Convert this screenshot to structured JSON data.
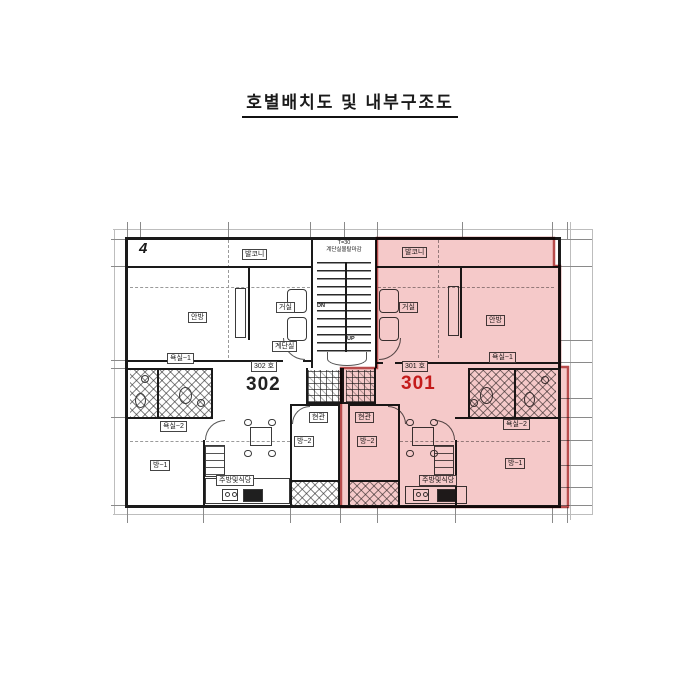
{
  "title": "호별배치도 및 내부구조도",
  "corner_mark": "4",
  "stairwell": {
    "note_top": "T=30",
    "note_bottom": "계단실몰탈마감",
    "label": "계단실",
    "down": "DN",
    "up": "UP"
  },
  "colors": {
    "highlight_fill": "#f5c6c6",
    "highlight_border": "#b84c4c",
    "unit_301_number_color": "#cc2222",
    "unit_302_number_color": "#222222",
    "wall_color": "#1a1a1a"
  },
  "unit_302": {
    "number": "302",
    "designation": "302 호",
    "balcony": "발코니",
    "master_bedroom": "안방",
    "living_room": "거실",
    "entrance": "현관",
    "bedroom1": "방~1",
    "bedroom2": "방~2",
    "bathroom1": "욕실~1",
    "bathroom2": "욕실~2",
    "kitchen_dining": "주방및식당"
  },
  "unit_301": {
    "number": "301",
    "designation": "301 호",
    "balcony": "발코니",
    "master_bedroom": "안방",
    "living_room": "거실",
    "entrance": "현관",
    "bedroom1": "방~1",
    "bedroom2": "방~2",
    "bathroom1": "욕실~1",
    "bathroom2": "욕실~2",
    "kitchen_dining": "주방및식당"
  }
}
